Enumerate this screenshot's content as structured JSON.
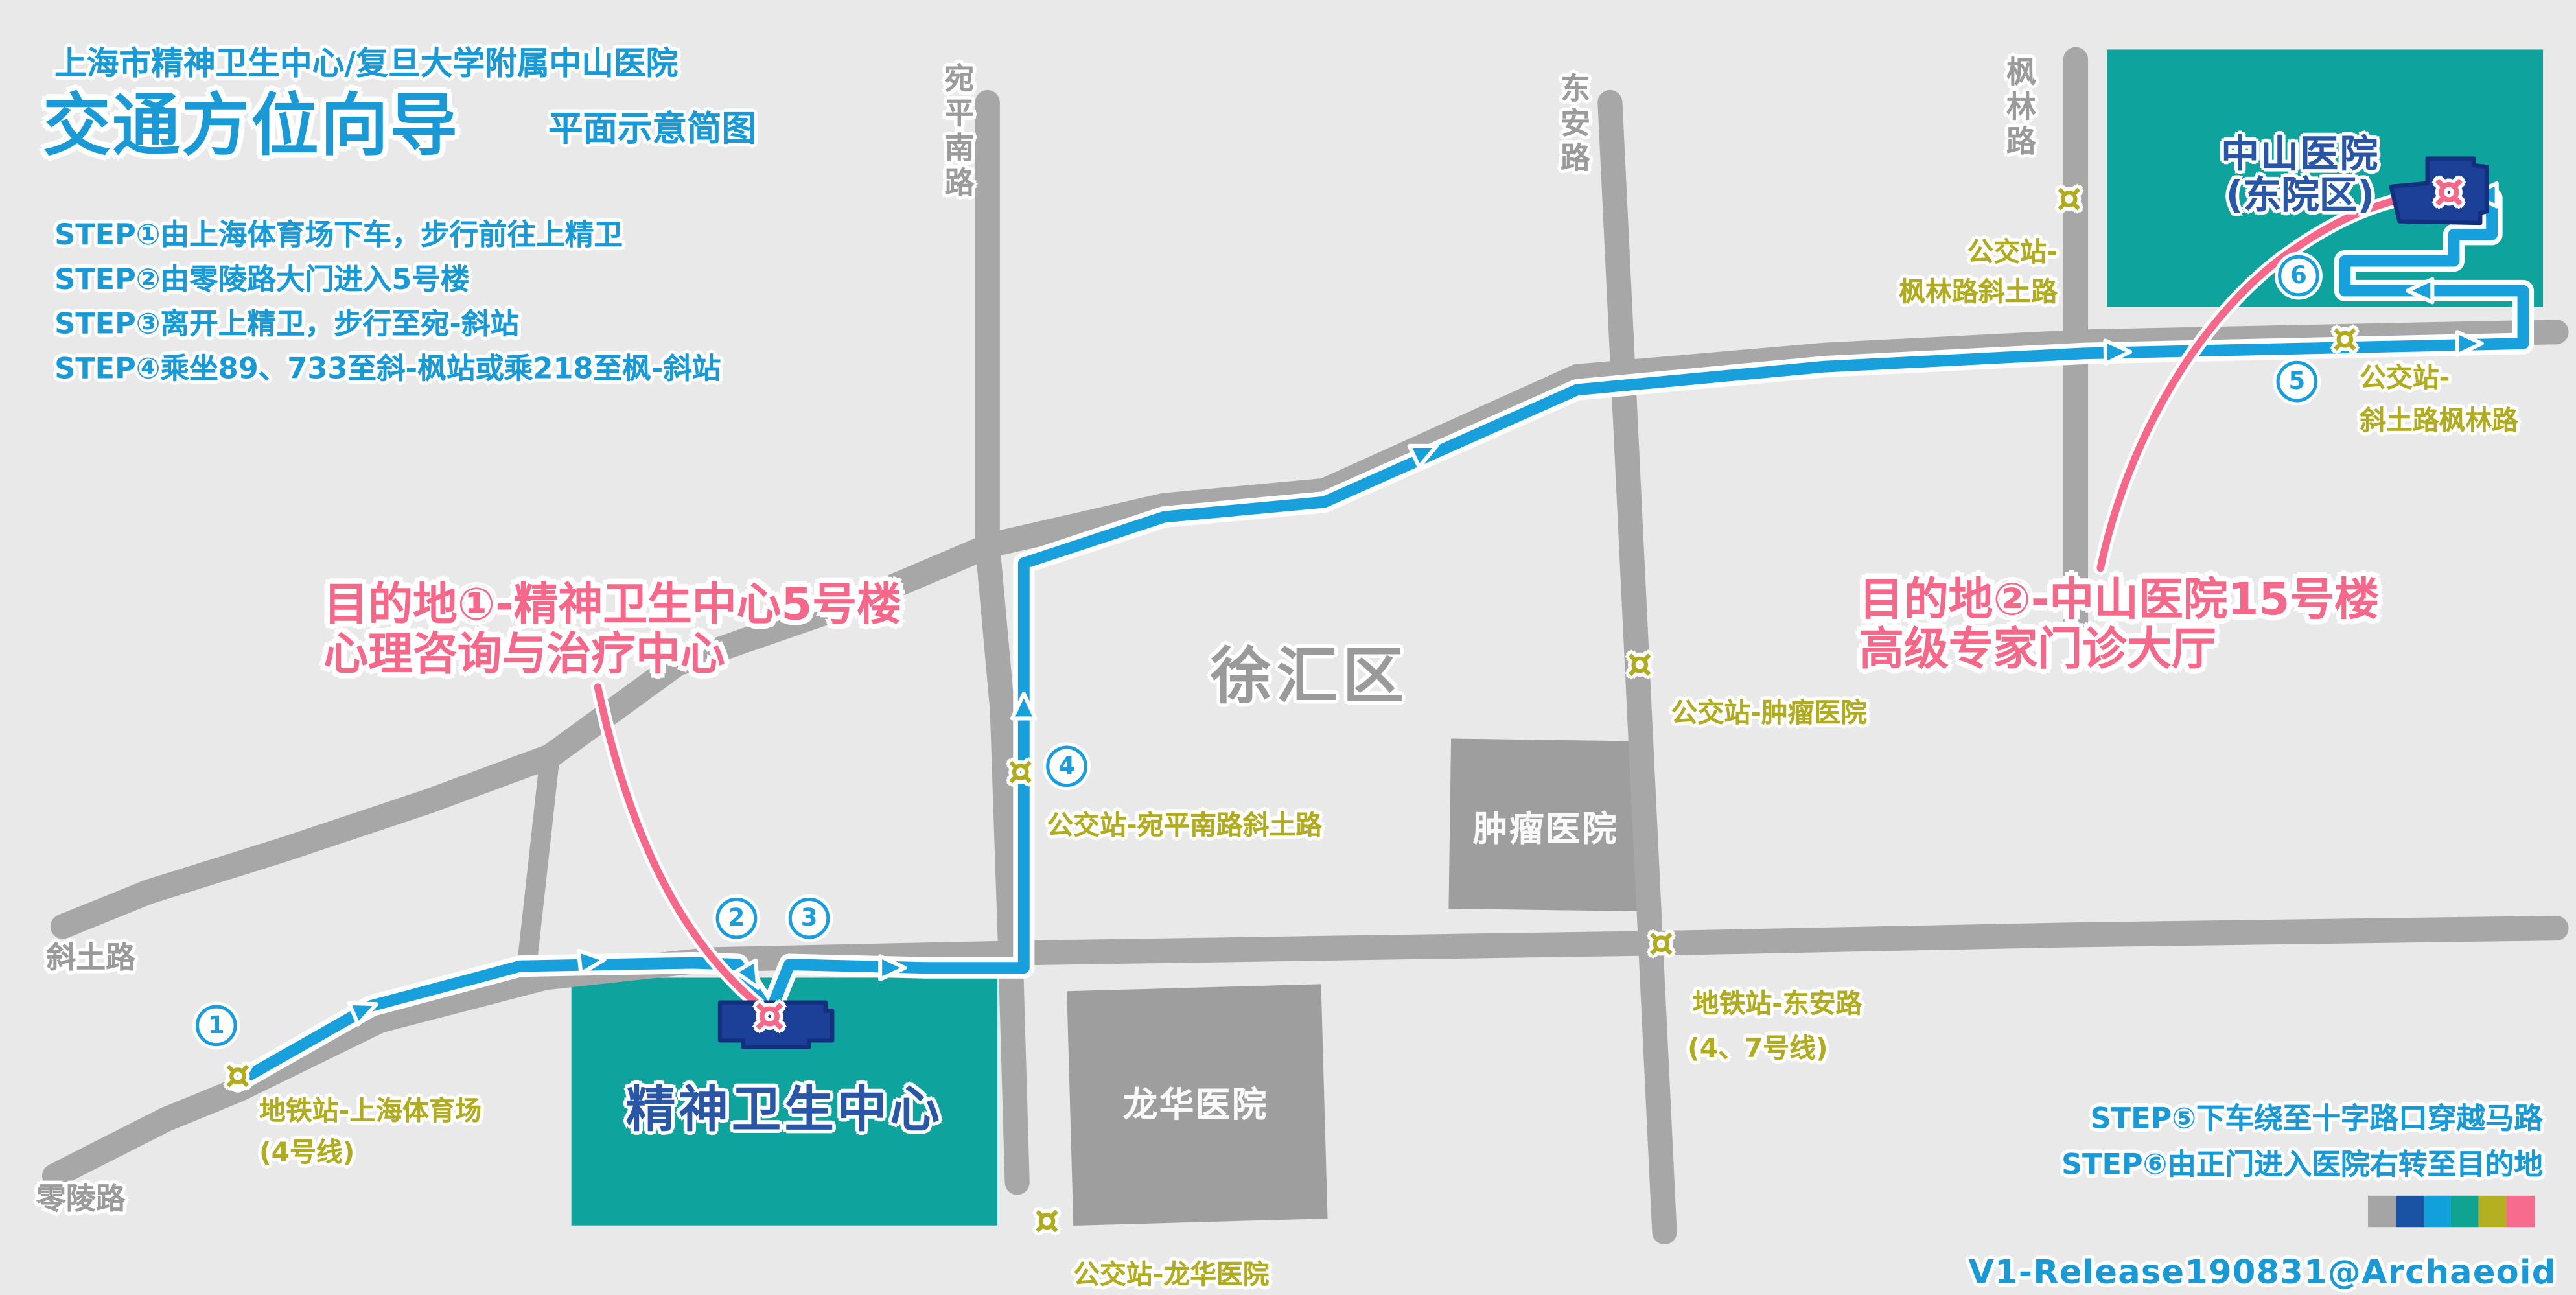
{
  "title": {
    "org_line": "上海市精神卫生中心/复旦大学附属中山医院",
    "main": "交通方位向导",
    "sub": "平面示意简图"
  },
  "steps_top": [
    "STEP①由上海体育场下车，步行前往上精卫",
    "STEP②由零陵路大门进入5号楼",
    "STEP③离开上精卫，步行至宛-斜站",
    "STEP④乘坐89、733至斜-枫站或乘218至枫-斜站"
  ],
  "steps_bottom": [
    "STEP⑤下车绕至十字路口穿越马路",
    "STEP⑥由正门进入医院右转至目的地"
  ],
  "credit": "V1-Release190831@Archaeoid",
  "district": "徐汇区",
  "roads": {
    "xietu": "斜土路",
    "lingling": "零陵路",
    "wanping": "宛平南路",
    "dongan": "东安路",
    "fenglin": "枫林路"
  },
  "buildings": {
    "jingwei": "精神卫生中心",
    "zhongshan_l1": "中山医院",
    "zhongshan_l2": "(东院区)",
    "zhongliu": "肿瘤医院",
    "longhua": "龙华医院"
  },
  "destinations": {
    "d1_l1": "目的地①-精神卫生中心5号楼",
    "d1_l2": "心理咨询与治疗中心",
    "d2_l1": "目的地②-中山医院15号楼",
    "d2_l2": "高级专家门诊大厅"
  },
  "stations": {
    "stadium_l1": "地铁站-上海体育场",
    "stadium_l2": "(4号线)",
    "wanping_xietu": "公交站-宛平南路斜土路",
    "longhua": "公交站-龙华医院",
    "zhongliu": "公交站-肿瘤医院",
    "dongan_l1": "地铁站-东安路",
    "dongan_l2": "(4、7号线)",
    "fenglin_xietu_l1": "公交站-",
    "fenglin_xietu_l2": "枫林路斜土路",
    "xietu_fenglin_l1": "公交站-",
    "xietu_fenglin_l2": "斜土路枫林路"
  },
  "badges": [
    "1",
    "2",
    "3",
    "4",
    "5",
    "6"
  ],
  "marker_glyph": "¤",
  "colors": {
    "route_blue": "#18a0dc",
    "road_gray": "#a7a7a7",
    "teal": "#0fa39e",
    "navy": "#1c3f97",
    "olive": "#b1ab20",
    "pink": "#f5688a",
    "text_blue": "#199ad6"
  },
  "legend": [
    "#a5a5a5",
    "#1a52a4",
    "#12a0dc",
    "#10a392",
    "#b5b021",
    "#f76b8e"
  ]
}
